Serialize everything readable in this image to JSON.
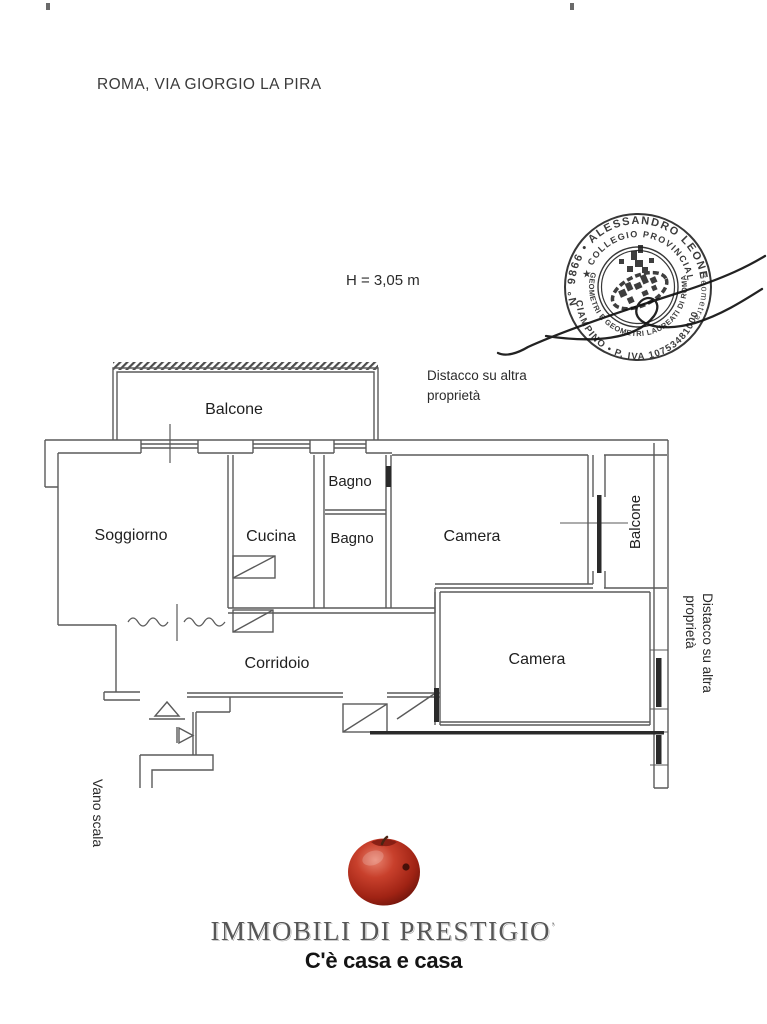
{
  "page": {
    "title": "ROMA, VIA GIORGIO LA PIRA",
    "height_note": "H = 3,05 m"
  },
  "plan": {
    "rooms": {
      "balcone_top": "Balcone",
      "soggiorno": "Soggiorno",
      "cucina": "Cucina",
      "bagno_1": "Bagno",
      "bagno_2": "Bagno",
      "camera_1": "Camera",
      "balcone_right": "Balcone",
      "corridoio": "Corridoio",
      "camera_2": "Camera"
    },
    "annotations": {
      "detach_line1": "Distacco su altra",
      "detach_line2": "proprietà",
      "vano_scala": "Vano scala"
    },
    "line_color": "#5a5a5a"
  },
  "stamp": {
    "reg_number_owner": "N° 9866 • ALESSANDRO LEONE",
    "owner_title": "Geometra",
    "city_vat": "CIAMPINO • P. IVA 10753481000",
    "college_top": "★ COLLEGIO PROVINCIALE ★",
    "college_bottom": "GEOMETRI E GEOMETRI LAUREATI DI ROMA",
    "ink_color": "#1a1a1a"
  },
  "logo": {
    "brand": "IMMOBILI DI PRESTIGIO",
    "brand_mark": "’",
    "tagline": "C'è casa e casa",
    "apple_color": "#b5301f"
  }
}
